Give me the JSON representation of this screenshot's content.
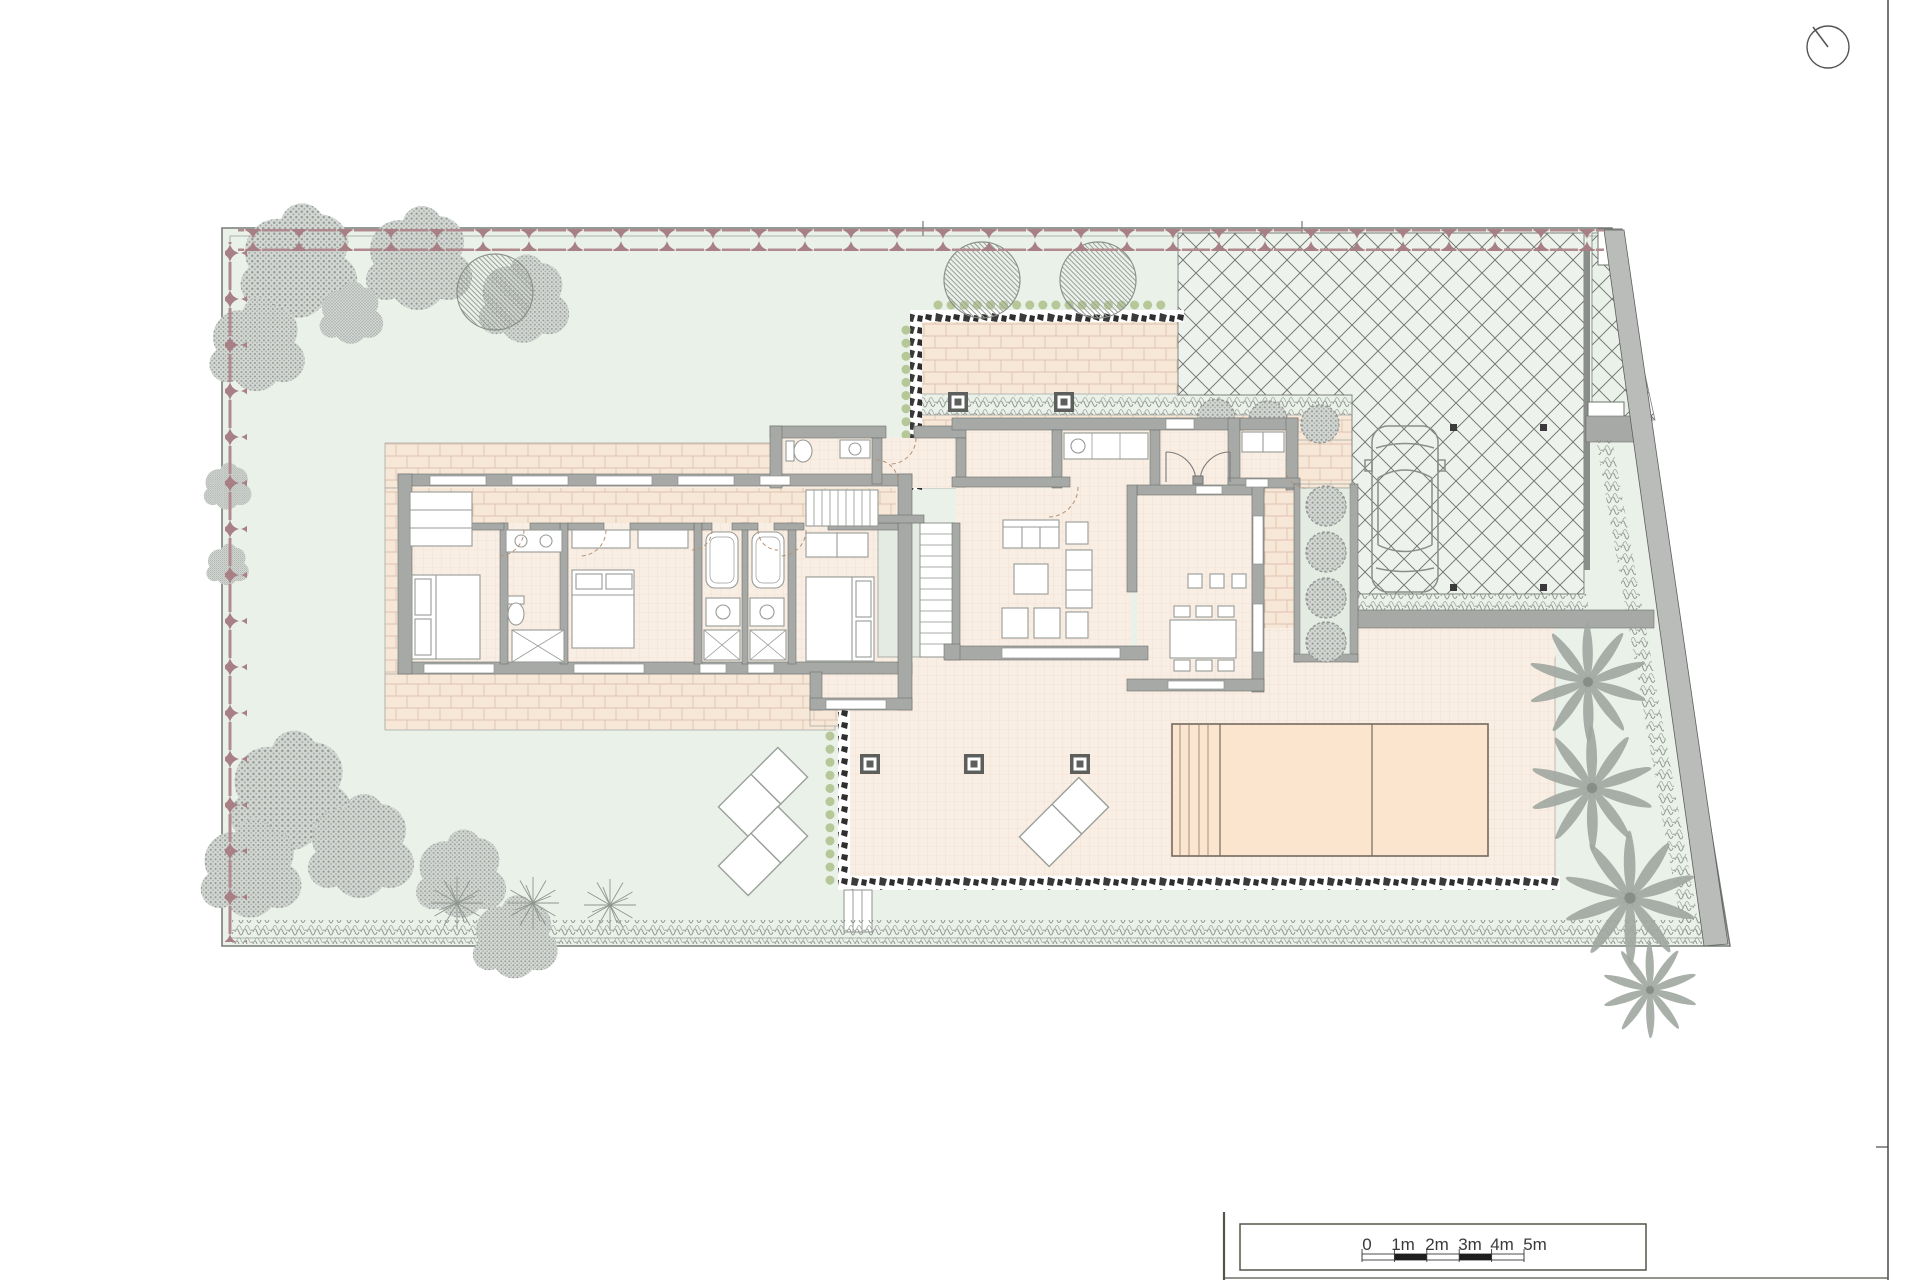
{
  "document": {
    "type": "architectural-site-plan",
    "floor": "ground-floor-villa-with-garden"
  },
  "scale_bar": {
    "labels": [
      "0",
      "1m",
      "2m",
      "3m",
      "4m",
      "5m"
    ],
    "segment_meters": 1,
    "total_meters": 5
  },
  "icons": {
    "north_indicator": "compass-circle-with-needle"
  },
  "colors": {
    "page_background": "#ffffff",
    "garden_green": "#eaf1e9",
    "driveway_green": "#edf2ed",
    "paving_brick": "#f6e7d7",
    "terrace_tile": "#f9eee3",
    "pool_water": "#fbe5cf",
    "wall_gray": "#a7a9a7",
    "vegetation_gray": "#a0a5a0",
    "flower_red": "#a87f84",
    "shrub_green": "#b6c897",
    "line_dark": "#4a4a4a"
  },
  "plan_inventory": {
    "beds": 3,
    "bathrooms": 3,
    "wc": 1,
    "pool": 1,
    "pool_sections": 2,
    "car": 1,
    "palm_trees": 4,
    "round_canopy_trees": 3,
    "sun_loungers": 3,
    "dining_seats": 6,
    "pergola_posts": 5,
    "staircases": 2
  }
}
